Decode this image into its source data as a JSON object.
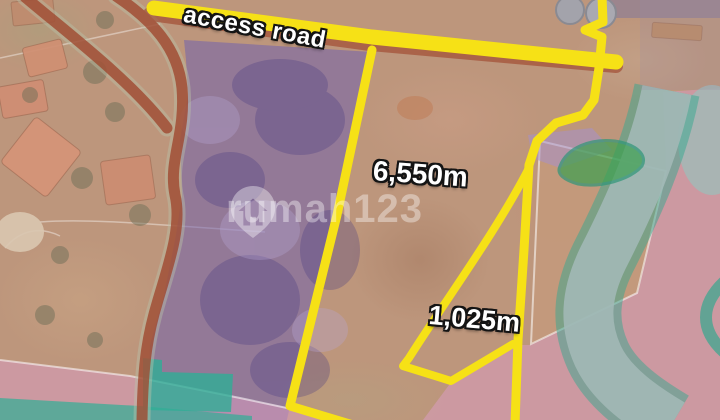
{
  "map": {
    "labels": {
      "access_road": "access road",
      "main_plot_area": "6,550m",
      "small_plot_area": "1,025m"
    },
    "watermark": {
      "brand": "rumah123"
    },
    "colors": {
      "boundary_yellow": "#f6e116",
      "zone_purple": "#6e5db0",
      "zone_pink": "#d99cc0",
      "zone_teal": "#2fae96",
      "road_red": "#9e4229",
      "river_grey": "#a2b8b6"
    }
  }
}
